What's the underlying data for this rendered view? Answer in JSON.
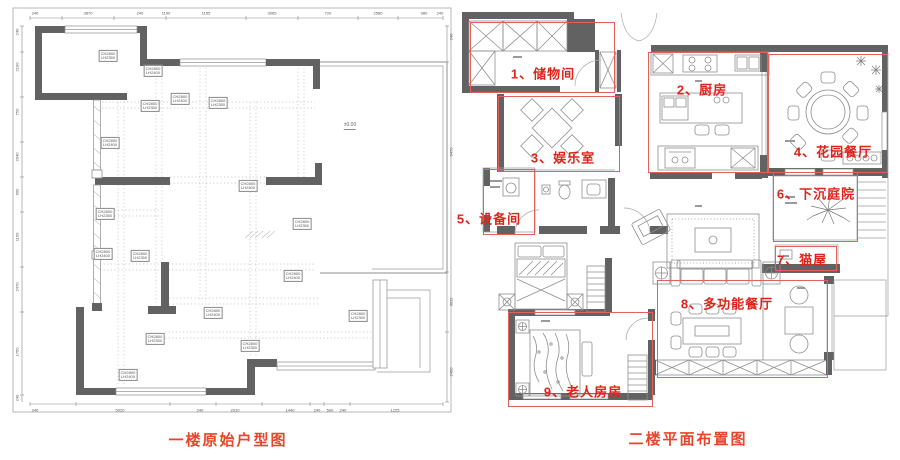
{
  "colors": {
    "wall": "#626262",
    "cad_line": "#8f8f8f",
    "annotation_box": "#e4605a",
    "annotation_text": "#e0231a",
    "caption_text": "#e6462c"
  },
  "left_plan": {
    "caption": "一楼原始户型图",
    "elevation_marker": "±0.00",
    "beam_labels": [
      {
        "x": 98,
        "y": 54,
        "t1": "CH2800",
        "t2": "LH2350"
      },
      {
        "x": 143,
        "y": 69,
        "t1": "CH2800",
        "t2": "LH2400"
      },
      {
        "x": 140,
        "y": 104,
        "t1": "CH2800",
        "t2": "LH2350"
      },
      {
        "x": 170,
        "y": 97,
        "t1": "CH2800",
        "t2": "LH2400"
      },
      {
        "x": 208,
        "y": 101,
        "t1": "CH2800",
        "t2": "LH2350"
      },
      {
        "x": 100,
        "y": 141,
        "t1": "CH2800",
        "t2": "LH2400"
      },
      {
        "x": 95,
        "y": 212,
        "t1": "CH2800",
        "t2": "LH2350"
      },
      {
        "x": 93,
        "y": 252,
        "t1": "CH2800",
        "t2": "LH2400"
      },
      {
        "x": 130,
        "y": 254,
        "t1": "CH2800",
        "t2": "LH2350"
      },
      {
        "x": 238,
        "y": 184,
        "t1": "CH2800",
        "t2": "LH2400"
      },
      {
        "x": 292,
        "y": 222,
        "t1": "CH2800",
        "t2": "LH2350"
      },
      {
        "x": 283,
        "y": 274,
        "t1": "CH2800",
        "t2": "LH2400"
      },
      {
        "x": 348,
        "y": 314,
        "t1": "CH2800",
        "t2": "LH2350"
      },
      {
        "x": 203,
        "y": 311,
        "t1": "CH2800",
        "t2": "LH2400"
      },
      {
        "x": 145,
        "y": 337,
        "t1": "CH2800",
        "t2": "LH2350"
      },
      {
        "x": 118,
        "y": 373,
        "t1": "CH2800",
        "t2": "LH2400"
      },
      {
        "x": 240,
        "y": 344,
        "t1": "CH2800",
        "t2": "LH2350"
      }
    ],
    "dims": {
      "top": [
        {
          "t": "240",
          "p": 25
        },
        {
          "t": "3870",
          "p": 78
        },
        {
          "t": "240",
          "p": 130
        },
        {
          "t": "1190",
          "p": 156
        },
        {
          "t": "1155",
          "p": 196
        },
        {
          "t": "3065",
          "p": 262
        },
        {
          "t": "720",
          "p": 318
        },
        {
          "t": "2580",
          "p": 368
        },
        {
          "t": "980",
          "p": 414
        },
        {
          "t": "240",
          "p": 430
        }
      ],
      "left": [
        {
          "t": "240",
          "p": 30
        },
        {
          "t": "2190",
          "p": 65
        },
        {
          "t": "750",
          "p": 110
        },
        {
          "t": "2040",
          "p": 155
        },
        {
          "t": "600",
          "p": 190
        },
        {
          "t": "1150",
          "p": 235
        },
        {
          "t": "2470",
          "p": 285
        },
        {
          "t": "1750",
          "p": 350
        },
        {
          "t": "240",
          "p": 396
        }
      ],
      "bottom": [
        {
          "t": "240",
          "p": 25
        },
        {
          "t": "5020",
          "p": 110
        },
        {
          "t": "240",
          "p": 190
        },
        {
          "t": "2010",
          "p": 225
        },
        {
          "t": "1440",
          "p": 280
        },
        {
          "t": "240",
          "p": 307
        },
        {
          "t": "500",
          "p": 320
        },
        {
          "t": "240",
          "p": 333
        },
        {
          "t": "1225",
          "p": 385
        }
      ],
      "right": [
        {
          "t": "240",
          "p": 35
        },
        {
          "t": "6470",
          "p": 150
        },
        {
          "t": "3011",
          "p": 300
        },
        {
          "t": "2450",
          "p": 370
        }
      ]
    }
  },
  "right_plan": {
    "caption": "二楼平面布置图",
    "rooms": [
      {
        "num": "1",
        "label": "1、储物间",
        "box": [
          15,
          22,
          145,
          71
        ],
        "label_at": [
          88,
          73
        ]
      },
      {
        "num": "2",
        "label": "2、厨房",
        "box": [
          193,
          52,
          120,
          121
        ],
        "label_at": [
          247,
          89
        ]
      },
      {
        "num": "3",
        "label": "3、娱乐室",
        "box": [
          43,
          96,
          122,
          76
        ],
        "label_at": [
          108,
          157
        ]
      },
      {
        "num": "4",
        "label": "4、花园餐厅",
        "box": [
          313,
          54,
          120,
          119
        ],
        "label_at": [
          378,
          151
        ]
      },
      {
        "num": "5",
        "label": "5、设备间",
        "box": [
          28,
          169,
          52,
          66
        ],
        "label_at": [
          34,
          218
        ]
      },
      {
        "num": "6",
        "label": "6、下沉庭院",
        "box": [
          318,
          172,
          85,
          70
        ],
        "label_at": [
          361,
          193
        ]
      },
      {
        "num": "7",
        "label": "7、猫屋",
        "box": [
          320,
          246,
          62,
          25
        ],
        "label_at": [
          347,
          259
        ]
      },
      {
        "num": "8",
        "label": "8、多功能餐厅",
        "box": [
          202,
          280,
          171,
          98
        ],
        "label_at": [
          272,
          303
        ]
      },
      {
        "num": "9",
        "label": "9、老人房房",
        "box": [
          53,
          312,
          145,
          95
        ],
        "label_at": [
          128,
          391
        ]
      }
    ]
  }
}
